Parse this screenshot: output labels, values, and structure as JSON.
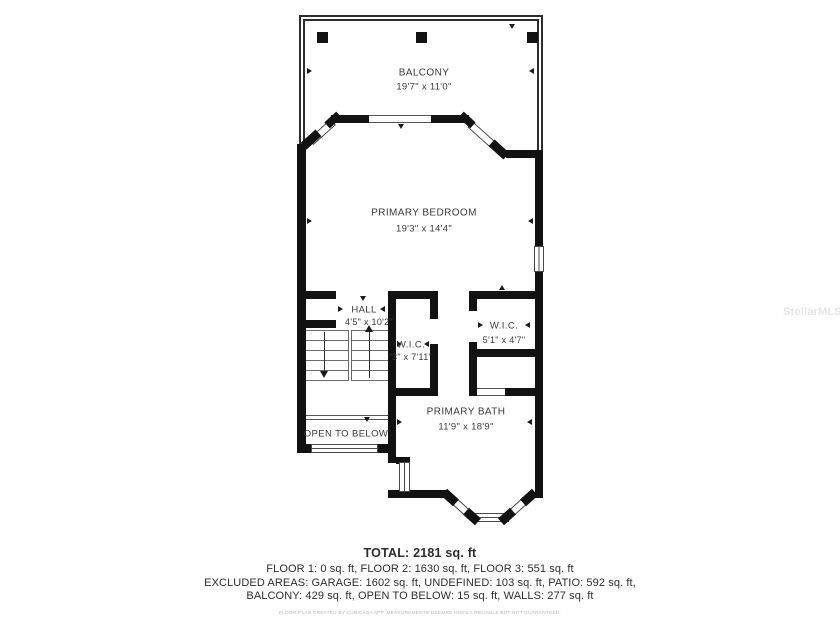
{
  "watermark": "StellarMLS",
  "rooms": {
    "balcony": {
      "name": "BALCONY",
      "dims": "19'7\" x 11'0\""
    },
    "primary_bedroom": {
      "name": "PRIMARY BEDROOM",
      "dims": "19'3\" x 14'4\""
    },
    "hall": {
      "name": "HALL",
      "dims": "4'5\" x 10'2\""
    },
    "wic_middle": {
      "name": "W.I.C.",
      "dims": "'3\" x 7'11\""
    },
    "wic_right": {
      "name": "W.I.C.",
      "dims": "5'1\" x 4'7\""
    },
    "primary_bath": {
      "name": "PRIMARY BATH",
      "dims": "11'9\" x 18'9\""
    },
    "open_to_below": {
      "name": "OPEN TO BELOW"
    }
  },
  "summary": {
    "total": "TOTAL: 2181 sq. ft",
    "floors": "FLOOR 1: 0 sq. ft, FLOOR 2: 1630 sq. ft, FLOOR 3: 551 sq. ft",
    "excluded_line1": "EXCLUDED AREAS: GARAGE: 1602 sq. ft, UNDEFINED: 103 sq. ft, PATIO: 592 sq. ft,",
    "excluded_line2": "BALCONY: 429 sq. ft, OPEN TO BELOW: 15 sq. ft, WALLS: 277 sq. ft",
    "disclaimer": "FLOOR PLAN CREATED BY CUBICASA APP. MEASUREMENTS DEEMED HIGHLY RELIABLE BUT NOT GUARANTEED."
  },
  "colors": {
    "wall": "#121212",
    "thin_line": "#4a4a4a",
    "text": "#3a3a3a",
    "watermark_color": "#e4e4e4"
  }
}
